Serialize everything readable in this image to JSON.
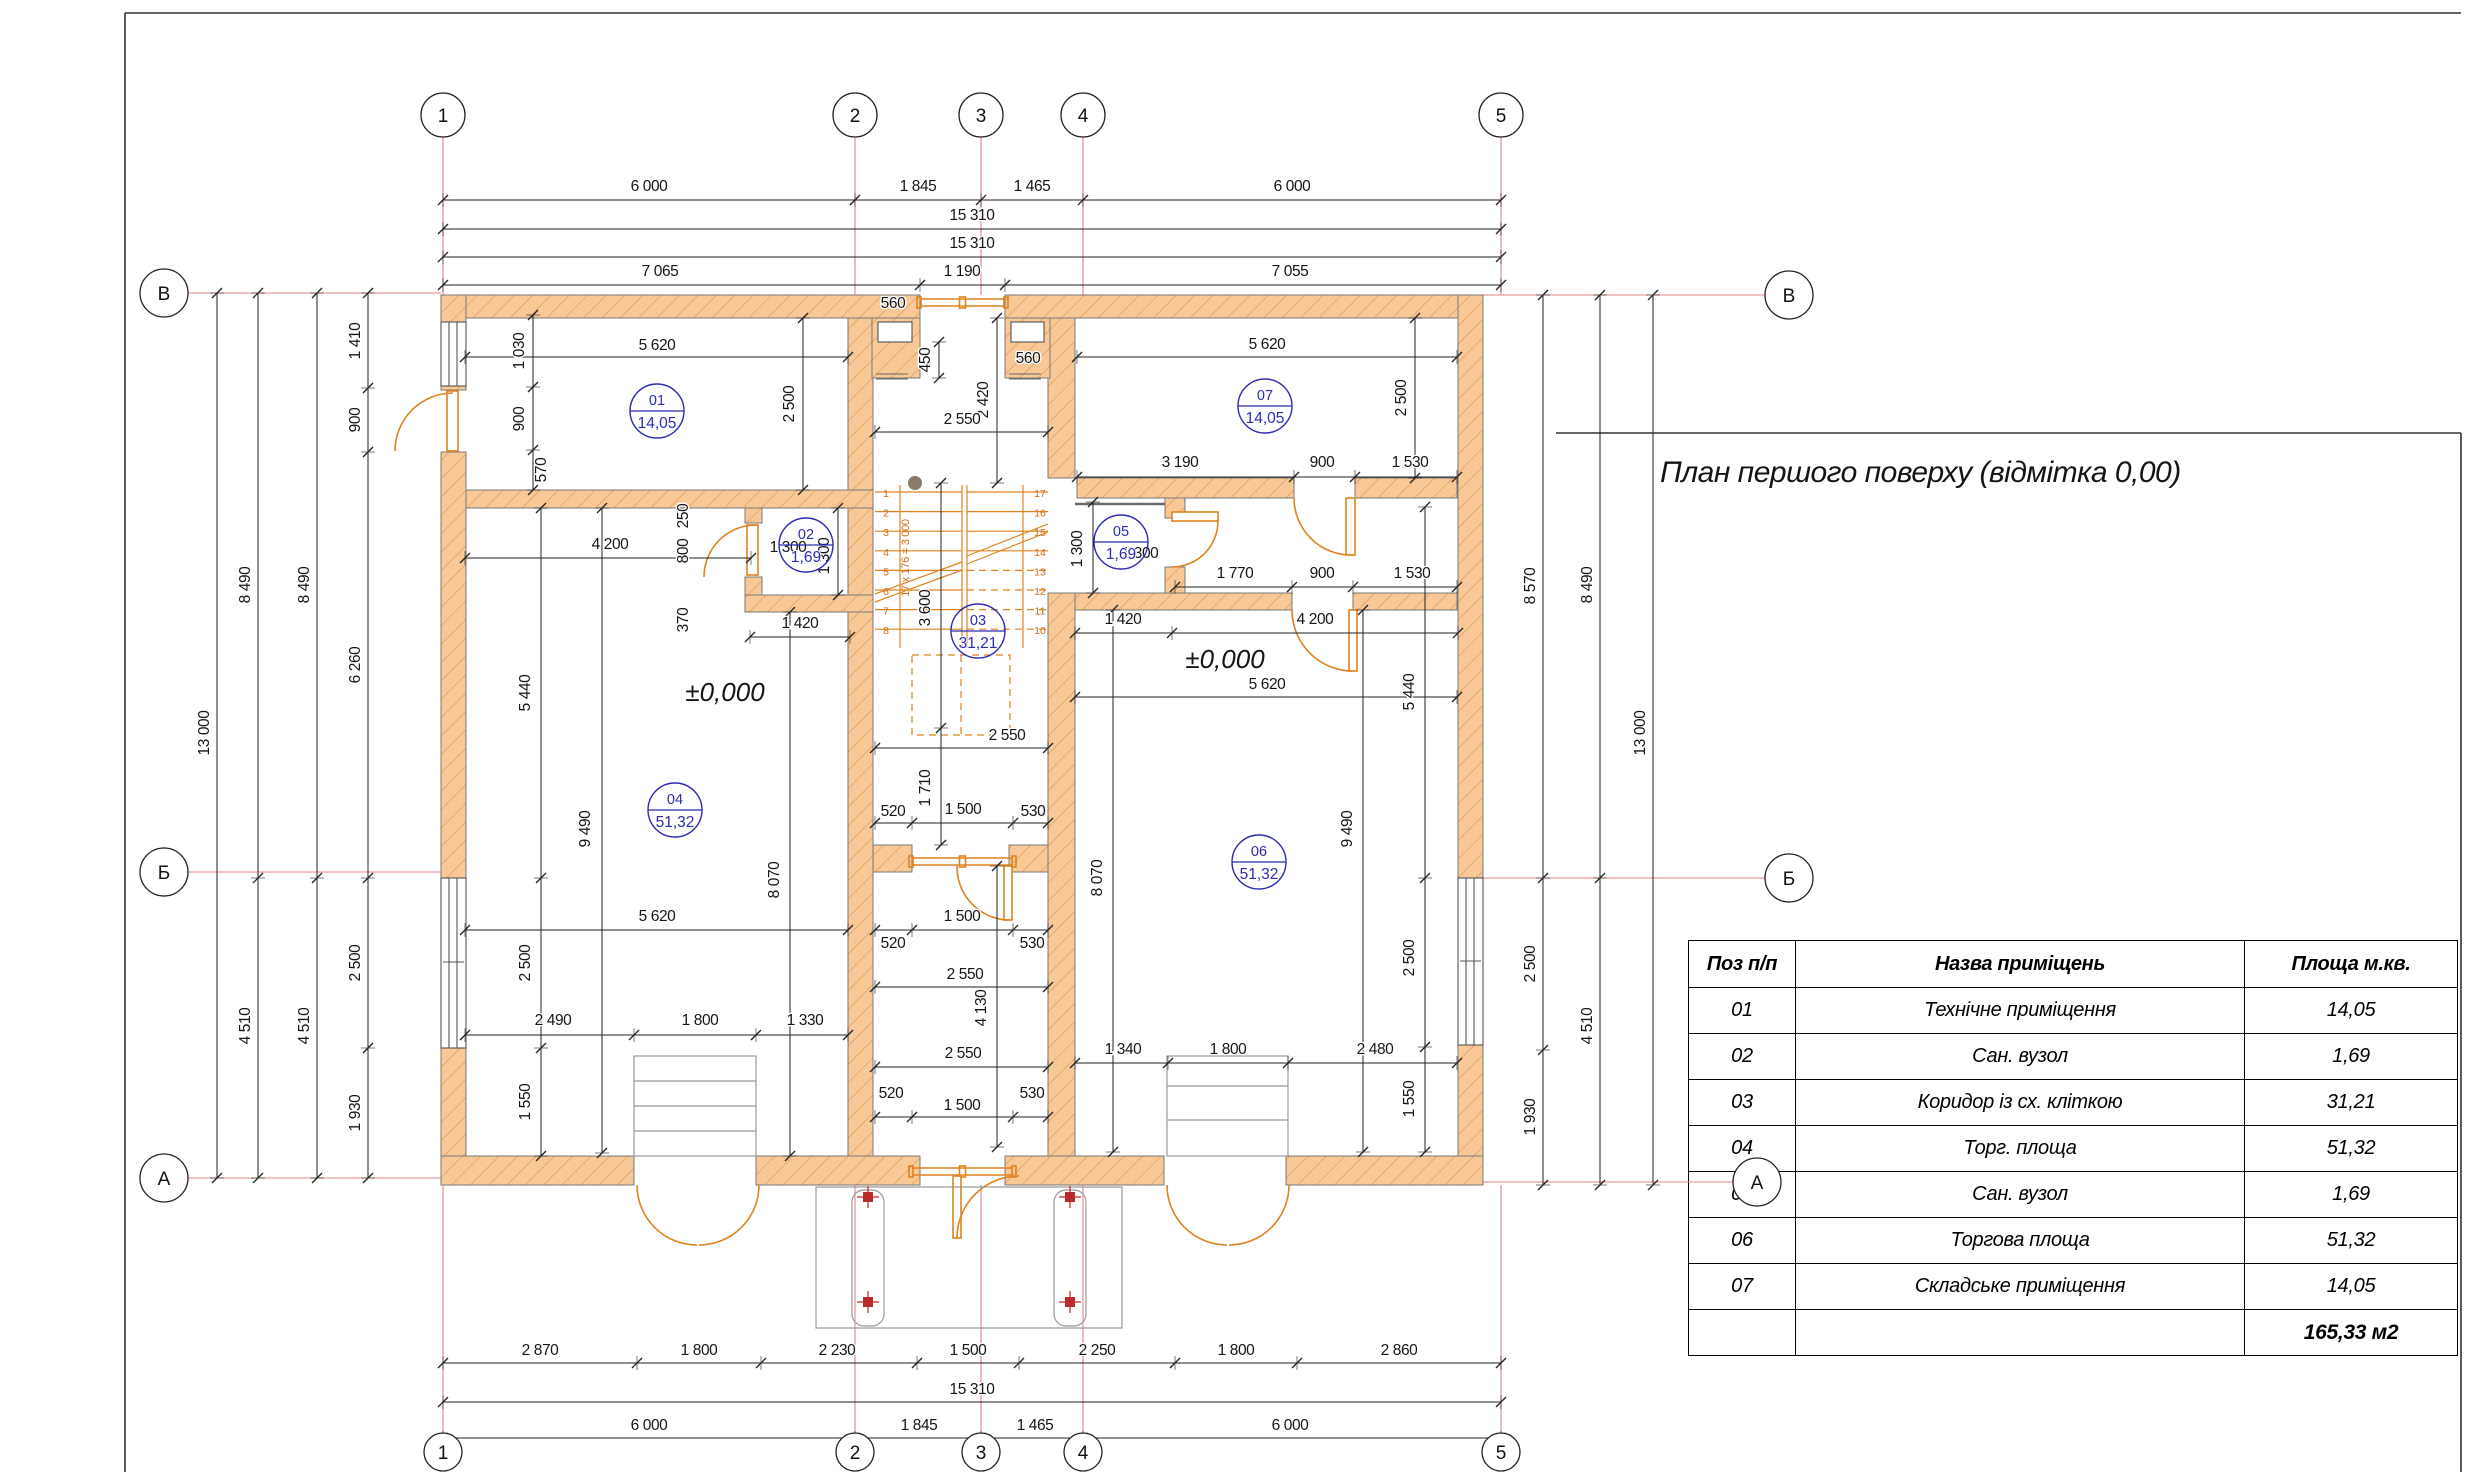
{
  "title": "План першого поверху (відмітка 0,00)",
  "table": {
    "headers": [
      "Поз п/п",
      "Назва приміщень",
      "Площа м.кв."
    ],
    "rows": [
      {
        "pos": "01",
        "name": "Технічне приміщення",
        "area": "14,05"
      },
      {
        "pos": "02",
        "name": "Сан. вузол",
        "area": "1,69"
      },
      {
        "pos": "03",
        "name": "Коридор із сх. кліткою",
        "area": "31,21"
      },
      {
        "pos": "04",
        "name": "Торг. площа",
        "area": "51,32"
      },
      {
        "pos": "05",
        "name": "Сан. вузол",
        "area": "1,69"
      },
      {
        "pos": "06",
        "name": "Торгова площа",
        "area": "51,32"
      },
      {
        "pos": "07",
        "name": "Складське приміщення",
        "area": "14,05"
      }
    ],
    "total": "165,33 м2"
  },
  "axes": [
    {
      "l": "1",
      "x": 443,
      "y": 115,
      "r": 22
    },
    {
      "l": "2",
      "x": 855,
      "y": 115,
      "r": 22
    },
    {
      "l": "3",
      "x": 981,
      "y": 115,
      "r": 22
    },
    {
      "l": "4",
      "x": 1083,
      "y": 115,
      "r": 22
    },
    {
      "l": "5",
      "x": 1501,
      "y": 115,
      "r": 22
    },
    {
      "l": "1",
      "x": 443,
      "y": 1452,
      "r": 19
    },
    {
      "l": "2",
      "x": 855,
      "y": 1452,
      "r": 19
    },
    {
      "l": "3",
      "x": 981,
      "y": 1452,
      "r": 19
    },
    {
      "l": "4",
      "x": 1083,
      "y": 1452,
      "r": 19
    },
    {
      "l": "5",
      "x": 1501,
      "y": 1452,
      "r": 19
    },
    {
      "l": "В",
      "x": 164,
      "y": 293,
      "r": 24
    },
    {
      "l": "Б",
      "x": 164,
      "y": 872,
      "r": 24
    },
    {
      "l": "А",
      "x": 164,
      "y": 1178,
      "r": 24
    },
    {
      "l": "В",
      "x": 1789,
      "y": 295,
      "r": 24
    },
    {
      "l": "Б",
      "x": 1789,
      "y": 878,
      "r": 24
    },
    {
      "l": "А",
      "x": 1757,
      "y": 1182,
      "r": 24
    }
  ],
  "rooms": [
    {
      "num": "01",
      "area": "14,05",
      "x": 657,
      "y": 411
    },
    {
      "num": "02",
      "area": "1,69",
      "x": 806,
      "y": 545
    },
    {
      "num": "03",
      "area": "31,21",
      "x": 978,
      "y": 631
    },
    {
      "num": "04",
      "area": "51,32",
      "x": 675,
      "y": 810
    },
    {
      "num": "05",
      "area": "1,69",
      "x": 1121,
      "y": 542
    },
    {
      "num": "06",
      "area": "51,32",
      "x": 1259,
      "y": 862
    },
    {
      "num": "07",
      "area": "14,05",
      "x": 1265,
      "y": 406
    }
  ],
  "levels": [
    {
      "t": "±0,000",
      "x": 725,
      "y": 701
    },
    {
      "t": "±0,000",
      "x": 1225,
      "y": 668
    }
  ],
  "stairs": {
    "left": [
      "1",
      "2",
      "3",
      "4",
      "5",
      "6",
      "7",
      "8"
    ],
    "right": [
      "17",
      "16",
      "15",
      "14",
      "13",
      "12",
      "11",
      "10"
    ],
    "note": "17 х 176 = 3 000"
  },
  "dims": [
    {
      "t": "6 000",
      "x": 649,
      "y": 191
    },
    {
      "t": "1 845",
      "x": 918,
      "y": 191
    },
    {
      "t": "1 465",
      "x": 1032,
      "y": 191
    },
    {
      "t": "6 000",
      "x": 1292,
      "y": 191
    },
    {
      "t": "15 310",
      "x": 972,
      "y": 220
    },
    {
      "t": "15 310",
      "x": 972,
      "y": 248
    },
    {
      "t": "7 065",
      "x": 660,
      "y": 276
    },
    {
      "t": "1 190",
      "x": 962,
      "y": 276
    },
    {
      "t": "7 055",
      "x": 1290,
      "y": 276
    },
    {
      "t": "2 870",
      "x": 540,
      "y": 1355
    },
    {
      "t": "1 800",
      "x": 699,
      "y": 1355
    },
    {
      "t": "2 230",
      "x": 837,
      "y": 1355
    },
    {
      "t": "1 500",
      "x": 968,
      "y": 1355
    },
    {
      "t": "2 250",
      "x": 1097,
      "y": 1355
    },
    {
      "t": "1 800",
      "x": 1236,
      "y": 1355
    },
    {
      "t": "2 860",
      "x": 1399,
      "y": 1355
    },
    {
      "t": "15 310",
      "x": 972,
      "y": 1394
    },
    {
      "t": "6 000",
      "x": 649,
      "y": 1430
    },
    {
      "t": "1 845",
      "x": 919,
      "y": 1430
    },
    {
      "t": "1 465",
      "x": 1035,
      "y": 1430
    },
    {
      "t": "6 000",
      "x": 1290,
      "y": 1430
    },
    {
      "t": "13 000",
      "x": 209,
      "y": 733,
      "r": 1
    },
    {
      "t": "8 490",
      "x": 250,
      "y": 585,
      "r": 1
    },
    {
      "t": "4 510",
      "x": 250,
      "y": 1026,
      "r": 1
    },
    {
      "t": "8 490",
      "x": 309,
      "y": 585,
      "r": 1
    },
    {
      "t": "4 510",
      "x": 309,
      "y": 1026,
      "r": 1
    },
    {
      "t": "1 410",
      "x": 360,
      "y": 341,
      "r": 1
    },
    {
      "t": "900",
      "x": 360,
      "y": 420,
      "r": 1
    },
    {
      "t": "6 260",
      "x": 360,
      "y": 665,
      "r": 1
    },
    {
      "t": "2 500",
      "x": 360,
      "y": 963,
      "r": 1
    },
    {
      "t": "1 930",
      "x": 360,
      "y": 1113,
      "r": 1
    },
    {
      "t": "8 570",
      "x": 1535,
      "y": 586,
      "r": 1
    },
    {
      "t": "2 500",
      "x": 1535,
      "y": 964,
      "r": 1
    },
    {
      "t": "1 930",
      "x": 1535,
      "y": 1117,
      "r": 1
    },
    {
      "t": "8 490",
      "x": 1592,
      "y": 585,
      "r": 1
    },
    {
      "t": "4 510",
      "x": 1592,
      "y": 1026,
      "r": 1
    },
    {
      "t": "13 000",
      "x": 1645,
      "y": 733,
      "r": 1
    },
    {
      "t": "5 620",
      "x": 657,
      "y": 350
    },
    {
      "t": "2 500",
      "x": 794,
      "y": 404,
      "r": 1
    },
    {
      "t": "1 030",
      "x": 524,
      "y": 351,
      "r": 1
    },
    {
      "t": "900",
      "x": 524,
      "y": 419,
      "r": 1
    },
    {
      "t": "570",
      "x": 546,
      "y": 470,
      "r": 1
    },
    {
      "t": "560",
      "x": 893,
      "y": 308
    },
    {
      "t": "450",
      "x": 930,
      "y": 360,
      "r": 1
    },
    {
      "t": "2 420",
      "x": 988,
      "y": 400,
      "r": 1
    },
    {
      "t": "560",
      "x": 1028,
      "y": 363
    },
    {
      "t": "2 550",
      "x": 962,
      "y": 424
    },
    {
      "t": "5 620",
      "x": 1267,
      "y": 349
    },
    {
      "t": "2 500",
      "x": 1406,
      "y": 398,
      "r": 1
    },
    {
      "t": "3 190",
      "x": 1180,
      "y": 467
    },
    {
      "t": "900",
      "x": 1322,
      "y": 467
    },
    {
      "t": "1 530",
      "x": 1410,
      "y": 467
    },
    {
      "t": "250",
      "x": 688,
      "y": 516,
      "r": 1
    },
    {
      "t": "800",
      "x": 688,
      "y": 551,
      "r": 1
    },
    {
      "t": "370",
      "x": 688,
      "y": 620,
      "r": 1
    },
    {
      "t": "1 300",
      "x": 788,
      "y": 552
    },
    {
      "t": "1 300",
      "x": 829,
      "y": 556,
      "r": 1
    },
    {
      "t": "1 420",
      "x": 800,
      "y": 628
    },
    {
      "t": "1 300",
      "x": 1082,
      "y": 549,
      "r": 1
    },
    {
      "t": "1 300",
      "x": 1140,
      "y": 558
    },
    {
      "t": "1 420",
      "x": 1124,
      "y": 625
    },
    {
      "t": "1 770",
      "x": 1235,
      "y": 578
    },
    {
      "t": "900",
      "x": 1322,
      "y": 578
    },
    {
      "t": "1 530",
      "x": 1412,
      "y": 578
    },
    {
      "t": "3 600",
      "x": 930,
      "y": 608,
      "r": 1
    },
    {
      "t": "1 710",
      "x": 930,
      "y": 788,
      "r": 1
    },
    {
      "t": "2 550",
      "x": 1007,
      "y": 740
    },
    {
      "t": "520",
      "x": 893,
      "y": 816
    },
    {
      "t": "1 500",
      "x": 963,
      "y": 814
    },
    {
      "t": "530",
      "x": 1033,
      "y": 816
    },
    {
      "t": "1 500",
      "x": 962,
      "y": 921
    },
    {
      "t": "520",
      "x": 893,
      "y": 948
    },
    {
      "t": "530",
      "x": 1032,
      "y": 948
    },
    {
      "t": "2 550",
      "x": 965,
      "y": 979
    },
    {
      "t": "4 130",
      "x": 986,
      "y": 1008,
      "r": 1
    },
    {
      "t": "2 550",
      "x": 963,
      "y": 1058
    },
    {
      "t": "520",
      "x": 891,
      "y": 1098
    },
    {
      "t": "530",
      "x": 1032,
      "y": 1098
    },
    {
      "t": "1 500",
      "x": 962,
      "y": 1110
    },
    {
      "t": "4 200",
      "x": 610,
      "y": 549
    },
    {
      "t": "5 440",
      "x": 530,
      "y": 693,
      "r": 1
    },
    {
      "t": "9 490",
      "x": 590,
      "y": 829,
      "r": 1
    },
    {
      "t": "2 500",
      "x": 530,
      "y": 963,
      "r": 1
    },
    {
      "t": "1 550",
      "x": 530,
      "y": 1102,
      "r": 1
    },
    {
      "t": "5 620",
      "x": 657,
      "y": 921
    },
    {
      "t": "8 070",
      "x": 779,
      "y": 880,
      "r": 1
    },
    {
      "t": "2 490",
      "x": 553,
      "y": 1025
    },
    {
      "t": "1 800",
      "x": 700,
      "y": 1025
    },
    {
      "t": "1 330",
      "x": 805,
      "y": 1025
    },
    {
      "t": "1 420",
      "x": 1123,
      "y": 624
    },
    {
      "t": "4 200",
      "x": 1315,
      "y": 624
    },
    {
      "t": "5 620",
      "x": 1267,
      "y": 689
    },
    {
      "t": "5 440",
      "x": 1414,
      "y": 692,
      "r": 1
    },
    {
      "t": "9 490",
      "x": 1352,
      "y": 829,
      "r": 1
    },
    {
      "t": "2 500",
      "x": 1414,
      "y": 958,
      "r": 1
    },
    {
      "t": "1 550",
      "x": 1414,
      "y": 1099,
      "r": 1
    },
    {
      "t": "8 070",
      "x": 1102,
      "y": 878,
      "r": 1
    },
    {
      "t": "1 340",
      "x": 1123,
      "y": 1054
    },
    {
      "t": "1 800",
      "x": 1228,
      "y": 1054
    },
    {
      "t": "2 480",
      "x": 1375,
      "y": 1054
    }
  ],
  "colors": {
    "wall_fill": "#f8c897",
    "wall_hatch": "#dfa05e",
    "wall_edge": "#7a7a7a",
    "orange": "#e0821e",
    "blue": "#2b2bb5",
    "axis_red": "#e08585",
    "marker_red": "#b03030",
    "gray": "#999999"
  }
}
